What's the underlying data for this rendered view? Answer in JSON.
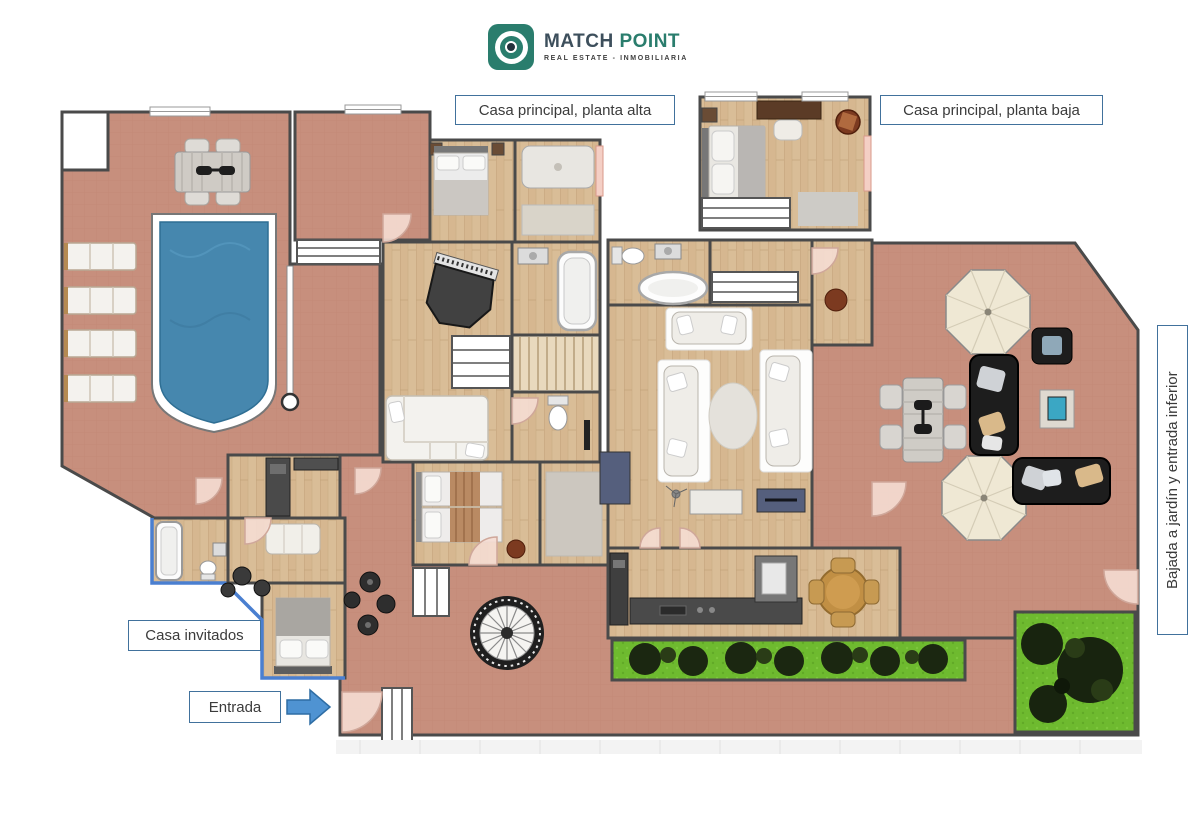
{
  "logo": {
    "title_primary": "MATCH",
    "title_secondary": "POINT",
    "subtitle": "REAL ESTATE - INMOBILIARIA"
  },
  "annotations": {
    "planta_alta": "Casa principal, planta alta",
    "planta_baja": "Casa principal, planta baja",
    "casa_invitados": "Casa invitados",
    "entrada": "Entrada",
    "bajada_jardin": "Bajada a jardín y entrada inferior"
  },
  "palette": {
    "terrace": "#c78f7d",
    "wood_floor": "#d9bd97",
    "pool": "#4687ae",
    "grass": "#6eba2f",
    "foliage": "#1b2711",
    "wall": "#4a4a4a",
    "label_border": "#41719c",
    "label_text": "#3b3b3b",
    "arrow_blue": "#4f93d2",
    "logo_teal": "#2a7d6d",
    "logo_slate": "#3d4f5c",
    "umbrella": "#efe8d4",
    "guest_wall_blue": "#4a7fd0",
    "navy_furniture": "#555f7d"
  },
  "icons": {
    "logo_icon": "bullseye-target",
    "entrada_arrow": "right-arrow"
  }
}
